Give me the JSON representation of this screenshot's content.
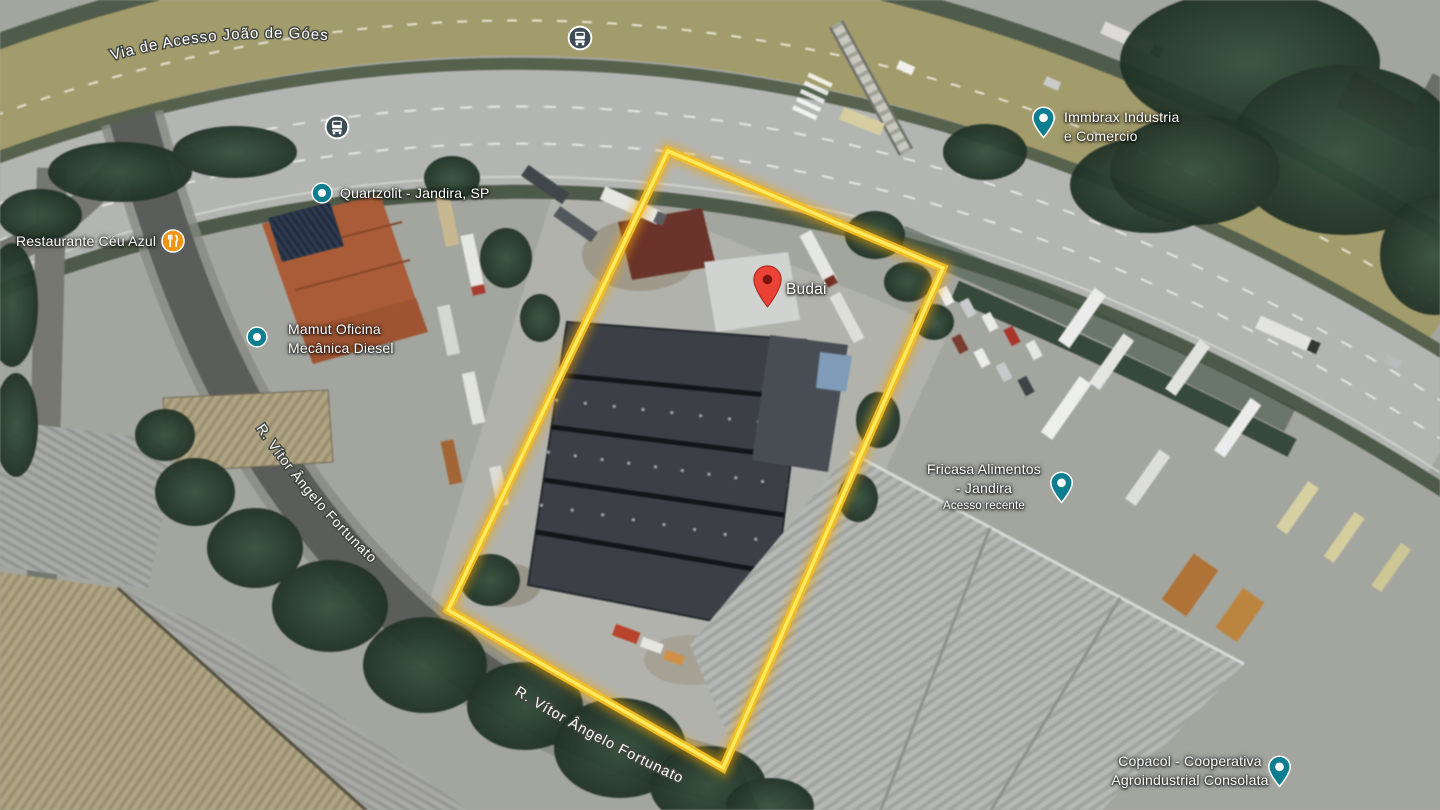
{
  "roads": {
    "via_de_acesso": "Via de Acesso João de Góes",
    "vitor_upper": "R. Vítor Ângelo Fortunato",
    "vitor_lower": "R. Vítor Ângelo Fortunato"
  },
  "pois": {
    "quartzolit": {
      "label": "Quartzolit - Jandira, SP"
    },
    "restaurante": {
      "label": "Restaurante Céu Azul"
    },
    "mamut": {
      "line1": "Mamut Oficina",
      "line2": "Mecânica Diesel"
    },
    "immbrax": {
      "line1": "Immbrax Industria",
      "line2": "e Comercio"
    },
    "budai": {
      "label": "Budai"
    },
    "fricasa": {
      "line1": "Fricasa Alimentos",
      "line2": "- Jandira",
      "note": "Acesso recente"
    },
    "copacol": {
      "line1": "Copacol - Cooperativa",
      "line2": "Agroindustrial Consolata"
    }
  },
  "selection": {
    "points": "668,151 943,268 723,768 448,610",
    "outline_color": "#f7c600"
  },
  "icons": {
    "bus_stop": "bus-stop-icon",
    "poi_dot": "poi-dot-icon",
    "poi_pin": "poi-pin-icon",
    "restaurant": "restaurant-icon",
    "place_pin": "place-pin-icon"
  },
  "colors": {
    "selection_yellow": "#f7c600",
    "pin_red": "#ea4335",
    "poi_teal": "#0d7e8f",
    "restaurant_orange": "#f09310",
    "bus_slate": "#3d4c55"
  }
}
